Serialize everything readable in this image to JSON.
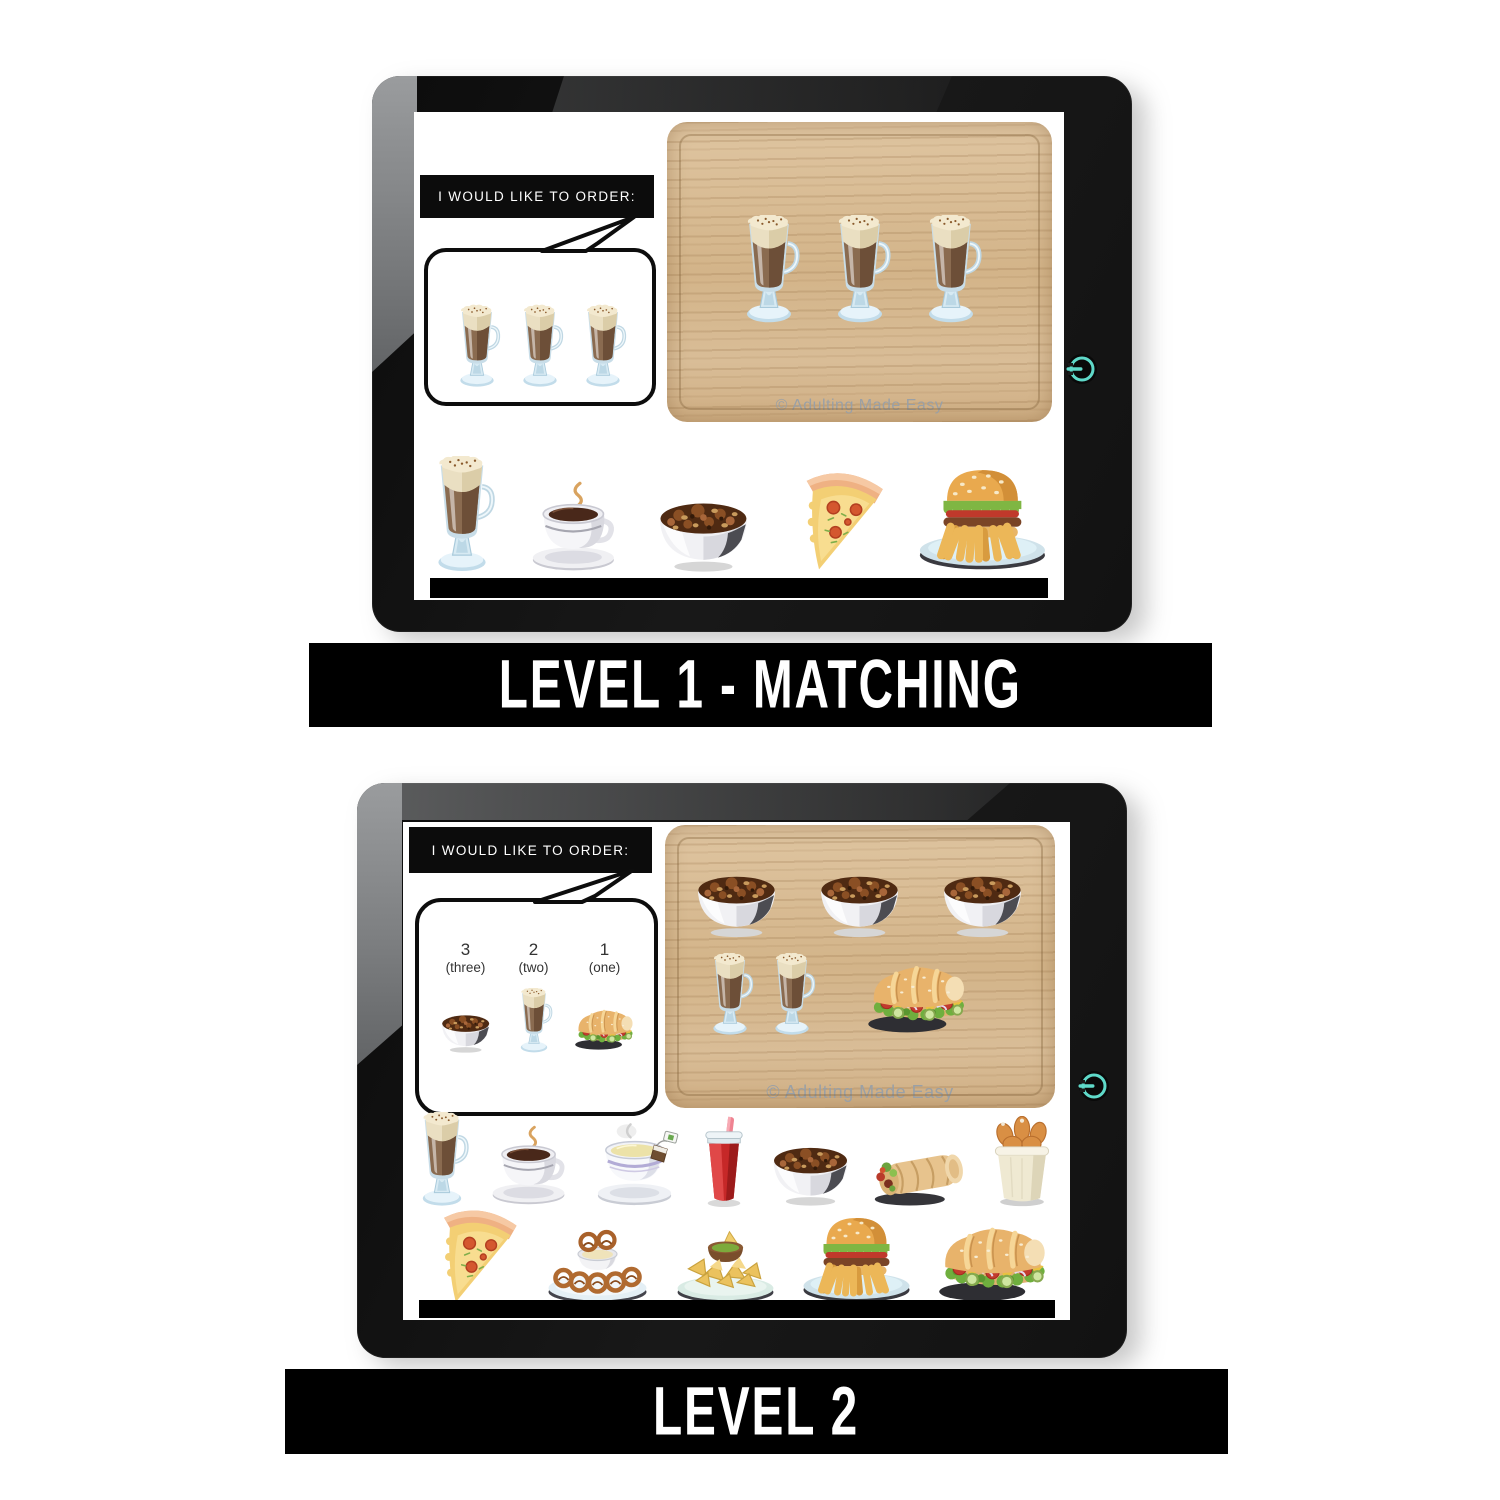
{
  "colors": {
    "accent_teal": "#5fd9c9",
    "banner_bg": "#000000",
    "banner_text": "#ffffff",
    "tray_wood": "#d6ba94",
    "screen_bg": "#ffffff",
    "frame": "#151515"
  },
  "banners": [
    {
      "label": "LEVEL 1 - MATCHING"
    },
    {
      "label": "LEVEL 2"
    }
  ],
  "tablets": [
    {
      "title": "I WOULD LIKE TO ORDER:",
      "watermark": "© Adulting Made Easy",
      "power_icon": "power-icon",
      "bubble": {
        "items": [
          {
            "icon": "latte"
          },
          {
            "icon": "latte"
          },
          {
            "icon": "latte"
          }
        ]
      },
      "tray_rows": [
        [
          {
            "icon": "latte",
            "count": 3
          }
        ]
      ],
      "menu_rows": [
        [
          "latte",
          "coffee",
          "stew-bowl",
          "pizza",
          "burger-fries"
        ]
      ]
    },
    {
      "title": "I WOULD LIKE TO ORDER:",
      "watermark": "© Adulting Made Easy",
      "power_icon": "power-icon",
      "bubble": {
        "items": [
          {
            "number": "3",
            "word": "(three)",
            "icon": "stew-bowl"
          },
          {
            "number": "2",
            "word": "(two)",
            "icon": "latte"
          },
          {
            "number": "1",
            "word": "(one)",
            "icon": "sub-sandwich"
          }
        ]
      },
      "tray_rows": [
        [
          {
            "icon": "stew-bowl",
            "count": 3
          }
        ],
        [
          {
            "icon": "latte",
            "count": 2
          },
          {
            "icon": "sub-sandwich",
            "count": 1
          }
        ]
      ],
      "menu_rows": [
        [
          "latte",
          "coffee",
          "tea",
          "soda",
          "stew-bowl",
          "burrito",
          "chicken-bucket"
        ],
        [
          "pizza",
          "pretzel-dip",
          "nachos",
          "burger-fries",
          "sub-sandwich"
        ]
      ]
    }
  ]
}
